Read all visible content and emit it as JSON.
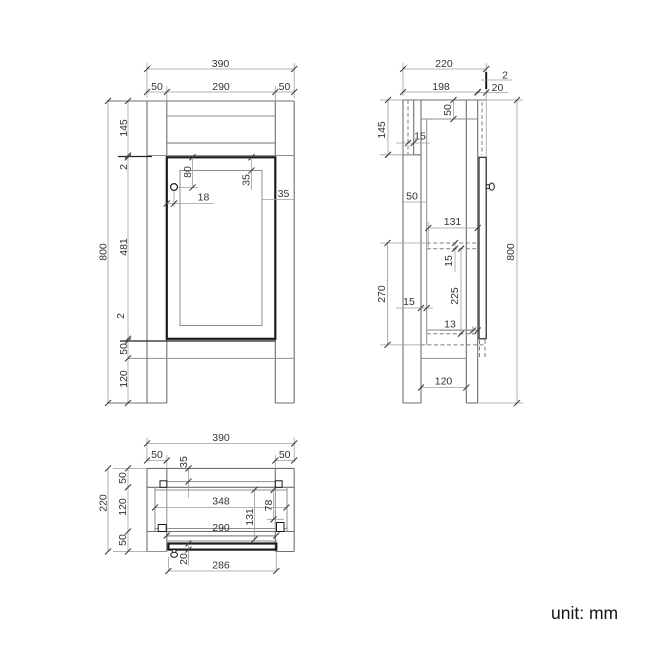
{
  "unit_label": "unit: mm",
  "colors": {
    "line_gray": "#8e8e8e",
    "line_black": "#1b1b1b",
    "dim_text": "#333333",
    "background": "#ffffff"
  },
  "front": {
    "total_width": "390",
    "left_post": "50",
    "opening_width": "290",
    "right_post": "50",
    "top_rail_height": "145",
    "top_gap": "2",
    "door_height": "481",
    "bottom_gap": "2",
    "bottom_rail_height": "50",
    "leg_height": "120",
    "overall_height": "800",
    "handle_drop": "80",
    "door_top_rail": "35",
    "handle_inset": "18",
    "door_stile": "35"
  },
  "side": {
    "total_depth": "220",
    "front_gap": "2",
    "body_depth": "198",
    "door_thickness": "20",
    "top_rail_depth": "50",
    "back_rail_height": "145",
    "back_panel_thickness": "15",
    "leg_depth": "50",
    "interior_depth": "131",
    "shelf_thickness": "15",
    "shelf_span": "270",
    "side_panel_thickness": "15",
    "shelf_to_bottom": "225",
    "front_rail_thickness": "13",
    "overall_height": "800",
    "leg_clear_depth": "120"
  },
  "plan": {
    "total_width": "390",
    "left_post": "50",
    "right_post": "50",
    "back_inset": "35",
    "total_depth": "220",
    "back_row": "50",
    "mid_row": "120",
    "front_row": "50",
    "interior_width": "348",
    "corner_depth": "78",
    "interior_depth": "131",
    "opening_width": "290",
    "door_thickness": "20",
    "door_width": "286"
  }
}
